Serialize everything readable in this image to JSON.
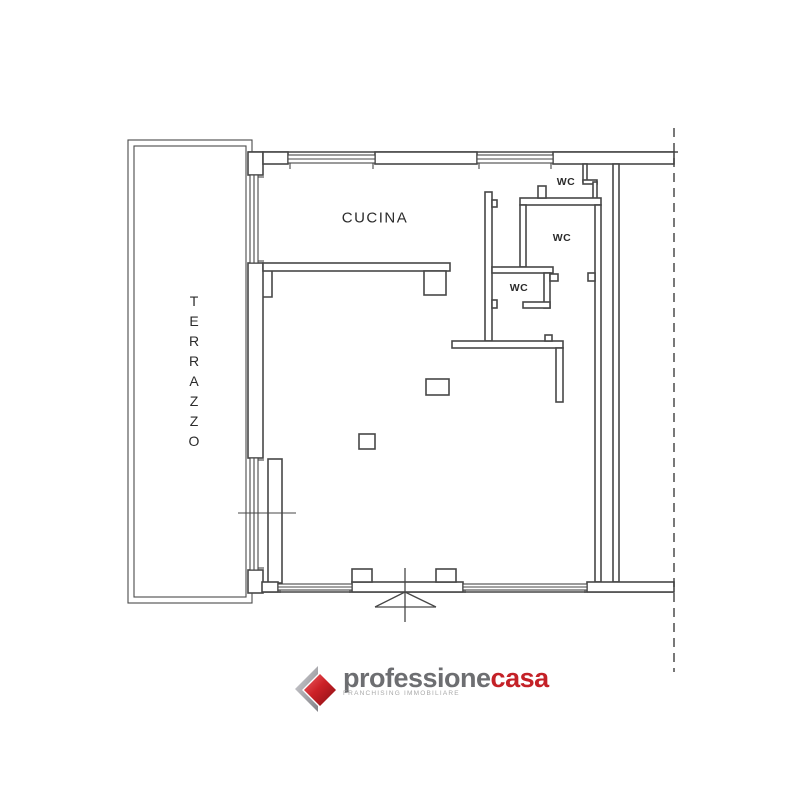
{
  "floor_plan": {
    "rooms": {
      "terrazzo": {
        "label": "TERRAZZO"
      },
      "cucina": {
        "label": "CUCINA"
      },
      "wc_top": {
        "label": "WC"
      },
      "wc_middle": {
        "label": "WC"
      },
      "wc_bottom": {
        "label": "WC"
      }
    },
    "symbols": [
      "window-symbol",
      "entrance-door-swing-icon",
      "property-boundary-dashed-line",
      "column-marker"
    ],
    "colors": {
      "wall": "#474747",
      "label_text": "#2b2b2b",
      "background": "#ffffff"
    }
  },
  "branding": {
    "logo_gray_part": "professione",
    "logo_red_part": "casa",
    "tagline": "FRANCHISING IMMOBILIARE",
    "colors": {
      "logo_gray": "#6d6e71",
      "logo_red": "#c42127",
      "tagline_gray": "#a8a8a8",
      "diamond_red": "#c0181d",
      "chevron_gray": "#a9a9ad"
    }
  }
}
